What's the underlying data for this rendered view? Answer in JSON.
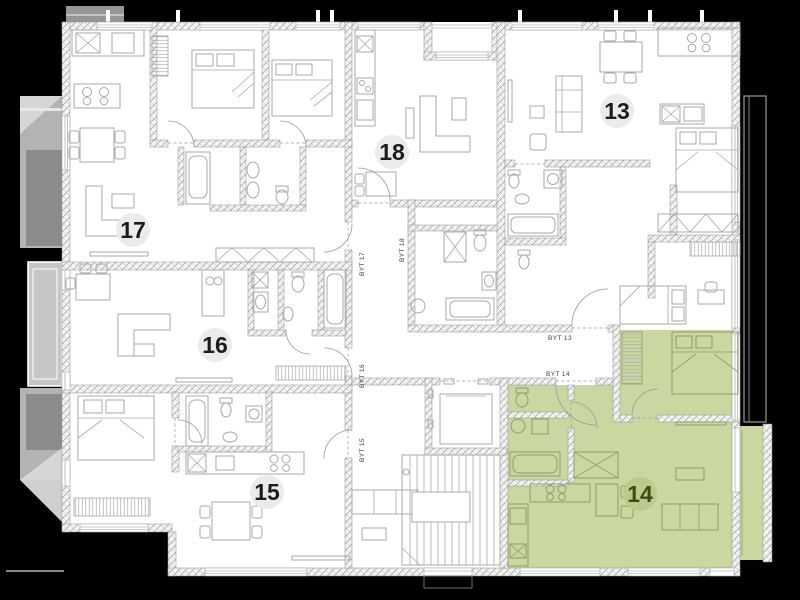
{
  "plan": {
    "type": "floor-plan",
    "units": {
      "u13": {
        "label": "13",
        "highlighted": false
      },
      "u14": {
        "label": "14",
        "highlighted": true
      },
      "u15": {
        "label": "15",
        "highlighted": false
      },
      "u16": {
        "label": "16",
        "highlighted": false
      },
      "u17": {
        "label": "17",
        "highlighted": false
      },
      "u18": {
        "label": "18",
        "highlighted": false
      }
    },
    "door_labels": {
      "byt13": "BYT 13",
      "byt14": "BYT 14",
      "byt15": "BYT 15",
      "byt16": "BYT 16",
      "byt17": "BYT 17",
      "byt18": "BYT 18"
    },
    "colors": {
      "background": "#000000",
      "paper": "#ffffff",
      "highlight_fill": "#c8d8a0",
      "highlight_badge": "#b9cc8b",
      "highlight_text": "#3d4a1d",
      "badge_fill": "#ebebeb",
      "badge_text": "#1c1c1c"
    }
  }
}
